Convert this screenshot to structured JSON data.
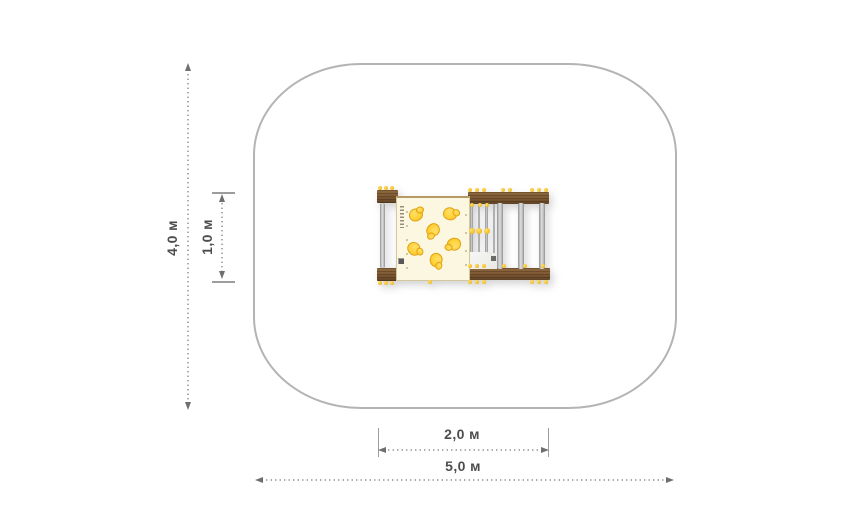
{
  "scene": {
    "type": "playground-equipment-plan-view",
    "background": "#ffffff"
  },
  "colors": {
    "zone_border": "#b4b4b4",
    "dim_line": "#9d9d9d",
    "dim_arrow": "#6f6f6f",
    "dim_text": "#4d4d4d",
    "wood": "#7b5733",
    "wood_light": "#8f6a3f",
    "wood_dark": "#5f4224",
    "panel_fill": "#fbf7e0",
    "panel_border": "#d5c79c",
    "hold": "#ffd23a",
    "hold_edge": "#e1a113",
    "bolt": "#f3c12b"
  },
  "dimensions": {
    "zone_height": {
      "label": "4,0 м",
      "orientation": "vertical"
    },
    "equipment_depth": {
      "label": "1,0 м",
      "orientation": "vertical"
    },
    "equipment_width": {
      "label": "2,0 м",
      "orientation": "horizontal"
    },
    "zone_width": {
      "label": "5,0 м",
      "orientation": "horizontal"
    }
  },
  "equipment": {
    "description": "climbing module top view: climbing wall panel with holds, ladder rungs, metal posts, wooden beams",
    "climbing_holds": [
      {
        "x": 19,
        "y": 17,
        "r": 0
      },
      {
        "x": 53,
        "y": 16,
        "r": 40
      },
      {
        "x": 36,
        "y": 32,
        "r": 160
      },
      {
        "x": 17,
        "y": 51,
        "r": 75
      },
      {
        "x": 57,
        "y": 46,
        "r": 200
      },
      {
        "x": 39,
        "y": 62,
        "r": 115
      }
    ],
    "panel_rivets": [
      {
        "x": 9,
        "y": 13
      },
      {
        "x": 9,
        "y": 27
      },
      {
        "x": 9,
        "y": 41
      },
      {
        "x": 9,
        "y": 55
      },
      {
        "x": 9,
        "y": 69
      },
      {
        "x": 68,
        "y": 16
      },
      {
        "x": 68,
        "y": 34
      },
      {
        "x": 68,
        "y": 52
      },
      {
        "x": 68,
        "y": 66
      }
    ],
    "ladder_bars": [
      94.5,
      102,
      109.5,
      117
    ],
    "posts": [
      123,
      144,
      165
    ],
    "mid_connectors": [
      94.5,
      102,
      109.5
    ],
    "bolts": [
      [
        3,
        2
      ],
      [
        9,
        2
      ],
      [
        15,
        2
      ],
      [
        3,
        96.5
      ],
      [
        9,
        96.5
      ],
      [
        15,
        96.5
      ],
      [
        93,
        4
      ],
      [
        100,
        4
      ],
      [
        107,
        4
      ],
      [
        126,
        4
      ],
      [
        133,
        4
      ],
      [
        155,
        4
      ],
      [
        162,
        4
      ],
      [
        169,
        4
      ],
      [
        95,
        18.5
      ],
      [
        102.5,
        18.5
      ],
      [
        110,
        18.5
      ],
      [
        93,
        80
      ],
      [
        100,
        80
      ],
      [
        107,
        80
      ],
      [
        127,
        80
      ],
      [
        148,
        80
      ],
      [
        166,
        80
      ],
      [
        93,
        95.5
      ],
      [
        100,
        95.5
      ],
      [
        107,
        95.5
      ],
      [
        155,
        95.5
      ],
      [
        162,
        95.5
      ],
      [
        169,
        95.5
      ],
      [
        53,
        95.5
      ]
    ]
  }
}
